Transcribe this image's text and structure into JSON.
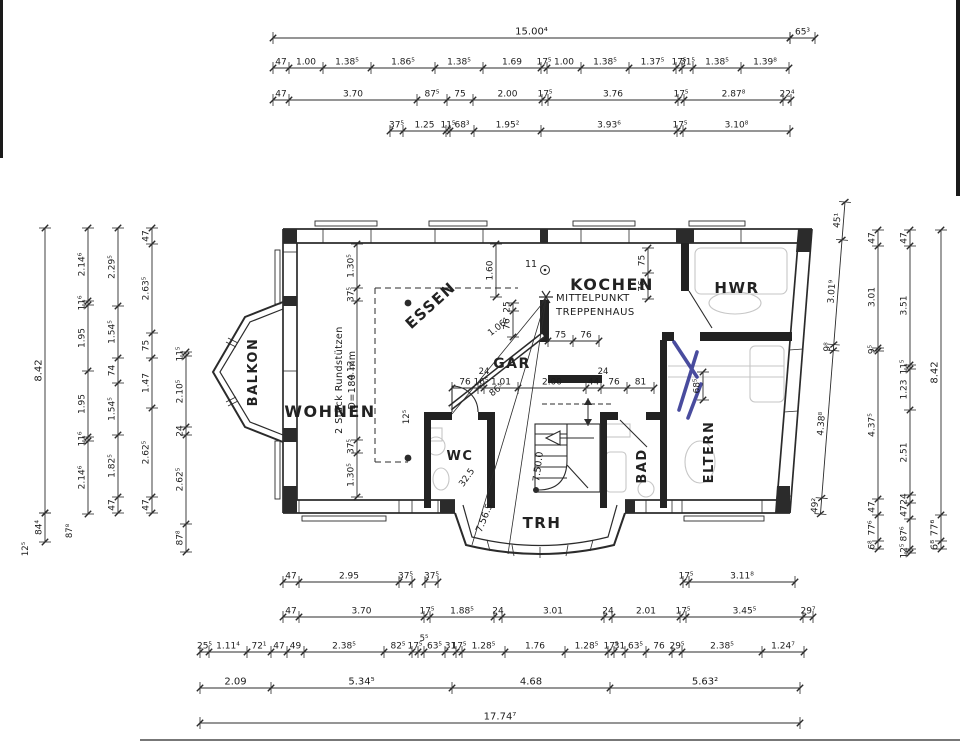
{
  "document": {
    "kind": "ground-floor plan scan"
  },
  "colors": {
    "ink": "#2b2b2b",
    "text": "#1c1c1c",
    "pen_blue": "#2a2d8e",
    "pencil": "#c6c6c6",
    "paper": "#ffffff"
  },
  "rooms": [
    {
      "id": "wohnen",
      "label": "WOHNEN",
      "x": 330,
      "y": 417,
      "rot": 0,
      "fs": 16
    },
    {
      "id": "essen",
      "label": "ESSEN",
      "x": 434,
      "y": 309,
      "rot": -42,
      "fs": 15
    },
    {
      "id": "kochen",
      "label": "KOCHEN",
      "x": 612,
      "y": 290,
      "rot": 0,
      "fs": 16
    },
    {
      "id": "hwr",
      "label": "HWR",
      "x": 737,
      "y": 293,
      "rot": 0,
      "fs": 15
    },
    {
      "id": "balkon",
      "label": "BALKON",
      "x": 257,
      "y": 372,
      "rot": -90,
      "fs": 13
    },
    {
      "id": "gar",
      "label": "GAR",
      "x": 512,
      "y": 368,
      "rot": 0,
      "fs": 14
    },
    {
      "id": "wc",
      "label": "WC",
      "x": 460,
      "y": 460,
      "rot": 0,
      "fs": 13
    },
    {
      "id": "bad",
      "label": "BAD",
      "x": 646,
      "y": 466,
      "rot": -90,
      "fs": 13
    },
    {
      "id": "trh",
      "label": "TRH",
      "x": 542,
      "y": 528,
      "rot": 0,
      "fs": 15
    },
    {
      "id": "eltern",
      "label": "ELTERN",
      "x": 713,
      "y": 452,
      "rot": -90,
      "fs": 13
    }
  ],
  "annotations": {
    "center_note": {
      "lines": [
        "MITTELPUNKT",
        "TREPPENHAUS"
      ],
      "x": 556,
      "y1": 301,
      "y2": 315,
      "fs": 10
    },
    "columns_note": {
      "lines": [
        "2 Stück Rundstützen",
        "D=180 mm"
      ],
      "x1": 342,
      "x2": 355,
      "y": 380,
      "fs": 9.5,
      "rot": -90
    },
    "stair_point_label": {
      "t": "11",
      "x": 531,
      "y": 267
    }
  },
  "floating_labels": [
    {
      "t": "24",
      "x": 484,
      "y": 374,
      "rot": 0,
      "fs": 8.5
    },
    {
      "t": "24",
      "x": 603,
      "y": 374,
      "rot": 0,
      "fs": 8.5
    },
    {
      "t": "5⁵",
      "x": 424,
      "y": 641,
      "rot": 0,
      "fs": 8.5
    },
    {
      "t": "12⁵",
      "x": 409,
      "y": 417,
      "rot": -90,
      "fs": 8.5
    },
    {
      "t": "87⁸",
      "x": 72,
      "y": 531,
      "rot": -90,
      "fs": 8.5
    },
    {
      "t": "12⁵",
      "x": 28,
      "y": 549,
      "rot": -90,
      "fs": 8.5
    },
    {
      "t": "1.06¹",
      "x": 500,
      "y": 329,
      "rot": -38,
      "fs": 9
    },
    {
      "t": "86⁵",
      "x": 498,
      "y": 392,
      "rot": -38,
      "fs": 9
    },
    {
      "t": "32.5",
      "x": 469,
      "y": 479,
      "rot": -55,
      "fs": 9
    },
    {
      "t": "7.50.0",
      "x": 541,
      "y": 467,
      "rot": -83,
      "fs": 9.5
    },
    {
      "t": "7.56.5",
      "x": 487,
      "y": 519,
      "rot": -68,
      "fs": 9.5
    },
    {
      "t": "11",
      "x": 531,
      "y": 267,
      "rot": 0,
      "fs": 9.5
    }
  ],
  "chains": [
    {
      "id": "top-overall",
      "dir": "h",
      "pos": 38,
      "fs": 10,
      "bounds": [
        273,
        790
      ],
      "labels": [
        "15.00⁴"
      ]
    },
    {
      "id": "top-eave-right",
      "dir": "h",
      "pos": 38,
      "bounds": [
        790,
        815
      ],
      "labels": [
        "65³"
      ]
    },
    {
      "id": "top-row2",
      "dir": "h",
      "pos": 68,
      "bounds": [
        273,
        289,
        323,
        371,
        435,
        483,
        541,
        547,
        581,
        629,
        676,
        682,
        693,
        741,
        789
      ],
      "labels": [
        "47",
        "1.00",
        "1.38⁵",
        "1.86⁵",
        "1.38⁵",
        "1.69",
        "17⁵",
        "1.00",
        "1.38⁵",
        "1.37⁵",
        "17⁵",
        "31⁵",
        "1.38⁵",
        "1.39⁸"
      ]
    },
    {
      "id": "top-row3",
      "dir": "h",
      "pos": 100,
      "bounds": [
        273,
        289,
        417,
        447,
        473,
        542,
        548,
        678,
        684,
        783,
        791
      ],
      "labels": [
        "47",
        "3.70",
        "87⁵",
        "75",
        "2.00",
        "17⁵",
        "3.76",
        "17⁵",
        "2.87⁸",
        "22⁴"
      ]
    },
    {
      "id": "top-row4",
      "dir": "h",
      "pos": 131,
      "bounds": [
        390,
        403,
        446,
        450,
        474,
        541,
        677,
        683,
        790
      ],
      "labels": [
        "37⁵",
        "1.25",
        "11⁵",
        "68³",
        "1.95²",
        "3.93⁶",
        "17⁵",
        "3.10⁸"
      ]
    },
    {
      "id": "left-overall",
      "dir": "v",
      "pos": 45,
      "fs": 10,
      "bounds": [
        228,
        513
      ],
      "labels": [
        "8.42"
      ]
    },
    {
      "id": "left-overall-ext",
      "dir": "v",
      "pos": 45,
      "bounds": [
        513,
        542
      ],
      "labels": [
        "84⁴"
      ]
    },
    {
      "id": "left-col2",
      "dir": "v",
      "pos": 88,
      "bounds": [
        228,
        301,
        305,
        371,
        437,
        441,
        514
      ],
      "labels": [
        "2.14⁶",
        "11⁶",
        "1.95",
        "1.95",
        "11⁶",
        "2.14⁶"
      ]
    },
    {
      "id": "left-col3",
      "dir": "v",
      "pos": 118,
      "bounds": [
        228,
        306,
        358,
        383,
        435,
        497,
        513
      ],
      "labels": [
        "2.29⁵",
        "1.54⁵",
        "74",
        "1.54⁵",
        "1.82⁵",
        "47"
      ]
    },
    {
      "id": "left-col4",
      "dir": "v",
      "pos": 152,
      "bounds": [
        228,
        244,
        333,
        358,
        408,
        497,
        513
      ],
      "labels": [
        "47",
        "2.63⁵",
        "75",
        "1.47",
        "2.62⁵",
        "47"
      ]
    },
    {
      "id": "left-col5",
      "dir": "v",
      "pos": 186,
      "bounds": [
        352,
        356,
        427,
        435,
        524,
        552
      ],
      "labels": [
        "11⁵",
        "2.10⁵",
        "24",
        "2.62⁵",
        "87⁸"
      ]
    },
    {
      "id": "right-diag",
      "dir": "v",
      "pos": 845,
      "tilt": 4.5,
      "bounds": [
        202,
        240,
        345,
        351,
        499,
        515
      ],
      "labels": [
        "45¹",
        "3.01⁹",
        "9⁸",
        "4.38⁸",
        "49²"
      ]
    },
    {
      "id": "right-col2",
      "dir": "v",
      "pos": 878,
      "bounds": [
        230,
        246,
        348,
        351,
        499,
        515,
        541,
        549
      ],
      "labels": [
        "47",
        "3.01",
        "9⁵",
        "4.37⁵",
        "47",
        "77⁶",
        "6⁸"
      ]
    },
    {
      "id": "right-col3",
      "dir": "v",
      "pos": 910,
      "bounds": [
        230,
        246,
        365,
        369,
        410,
        495,
        503,
        519,
        549,
        553
      ],
      "labels": [
        "47",
        "3.51",
        "11⁵",
        "1.23",
        "2.51",
        "24",
        "47",
        "87⁶",
        "12⁵"
      ]
    },
    {
      "id": "right-overall",
      "dir": "v",
      "pos": 941,
      "fs": 10,
      "bounds": [
        230,
        515,
        541,
        549
      ],
      "labels": [
        "8.42",
        "77⁶",
        "6⁸"
      ]
    },
    {
      "id": "bot-row1-left",
      "dir": "h",
      "pos": 582,
      "bounds": [
        283,
        299,
        399,
        412
      ],
      "labels": [
        "47",
        "2.95",
        "37⁵"
      ]
    },
    {
      "id": "bot-row1-mid",
      "dir": "h",
      "pos": 582,
      "bounds": [
        425,
        438
      ],
      "labels": [
        "37⁵"
      ]
    },
    {
      "id": "bot-row1-right",
      "dir": "h",
      "pos": 582,
      "bounds": [
        683,
        689,
        795
      ],
      "labels": [
        "17⁵",
        "3.11⁸"
      ]
    },
    {
      "id": "bot-row2",
      "dir": "h",
      "pos": 617,
      "bounds": [
        283,
        299,
        424,
        430,
        494,
        502,
        604,
        612,
        680,
        686,
        803,
        813
      ],
      "labels": [
        "47",
        "3.70",
        "17⁵",
        "1.88⁵",
        "24",
        "3.01",
        "24",
        "2.01",
        "17⁵",
        "3.45⁵",
        "29⁷"
      ]
    },
    {
      "id": "bot-row3",
      "dir": "h",
      "pos": 652,
      "bounds": [
        200,
        209,
        247,
        271,
        287,
        304,
        384,
        412,
        418,
        424,
        445,
        456,
        462,
        505,
        565,
        608,
        614,
        625,
        646,
        672,
        682,
        762,
        804
      ],
      "labels": [
        "25⁵",
        "1.11⁴",
        "72¹",
        "47",
        "49",
        "2.38⁵",
        "82⁵",
        "17⁵",
        "",
        "63⁵",
        "31",
        "17⁵",
        "1.28⁵",
        "1.76",
        "1.28⁵",
        "17⁵",
        "31",
        "63⁵",
        "76",
        "29⁵",
        "2.38⁵",
        "1.24⁷"
      ]
    },
    {
      "id": "bot-row4",
      "dir": "h",
      "pos": 688,
      "fs": 10,
      "bounds": [
        200,
        271,
        452,
        610,
        800
      ],
      "labels": [
        "2.09",
        "5.34⁵",
        "4.68",
        "5.63²"
      ]
    },
    {
      "id": "bot-overall",
      "dir": "h",
      "pos": 723,
      "fs": 10,
      "bounds": [
        200,
        800
      ],
      "labels": [
        "17.74⁷"
      ]
    },
    {
      "id": "int-left",
      "dir": "v",
      "pos": 357,
      "bounds": [
        244,
        288,
        301,
        440,
        453,
        497
      ],
      "labels": [
        "1.30⁵",
        "37⁵",
        "4.12",
        "37⁵",
        "1.30⁵"
      ]
    },
    {
      "id": "int-hall",
      "dir": "h",
      "pos": 388,
      "bounds": [
        452,
        478,
        484,
        518,
        586,
        601,
        627,
        654
      ],
      "labels": [
        "76",
        "16⁵",
        "1.01",
        "2.00",
        "44",
        "76",
        "81"
      ]
    },
    {
      "id": "int-kochen-left",
      "dir": "v",
      "pos": 496,
      "bounds": [
        244,
        297
      ],
      "labels": [
        "1.60"
      ]
    },
    {
      "id": "int-essen-right",
      "dir": "v",
      "pos": 513,
      "bounds": [
        303,
        311,
        337
      ],
      "labels": [
        "25",
        "76"
      ]
    },
    {
      "id": "int-kochen-right",
      "dir": "v",
      "pos": 648,
      "bounds": [
        248,
        273,
        299
      ],
      "labels": [
        "75",
        "76"
      ]
    },
    {
      "id": "int-kochen-pier",
      "dir": "h",
      "pos": 341,
      "bounds": [
        548,
        573,
        599
      ],
      "labels": [
        "75",
        "76"
      ]
    },
    {
      "id": "int-eltern-door",
      "dir": "v",
      "pos": 703,
      "bounds": [
        372,
        400
      ],
      "labels": [
        "68⁵"
      ]
    }
  ]
}
